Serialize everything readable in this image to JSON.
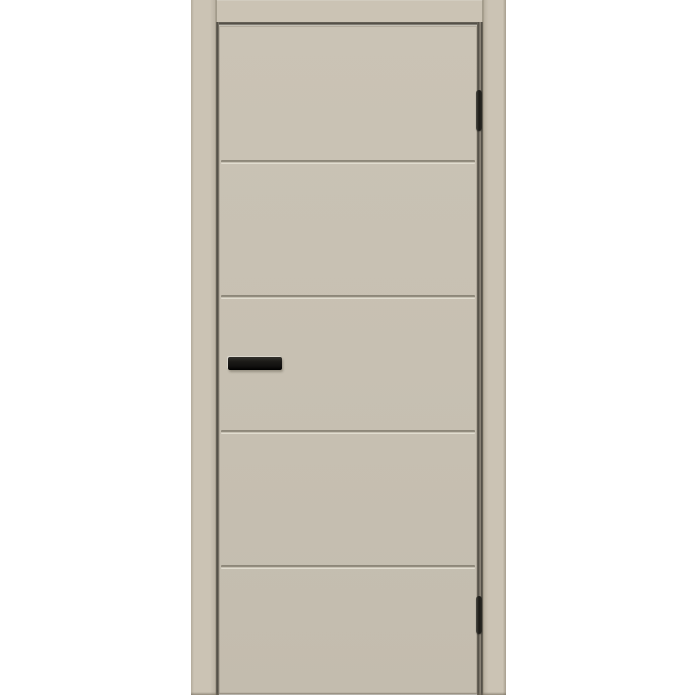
{
  "meta": {
    "type": "product-photo",
    "alt": "Light cashmere-beige painted interior door shown installed in a matching frame on a plain white background. The flush door leaf has four recessed horizontal grooves forming five flat panels, a rectangular matte black bar handle on the left side of the middle panel, and two slim black hinges on the right edge."
  },
  "door": {
    "finish": "cashmere beige, matte painted",
    "leaf": {
      "style": "flush leaf with horizontal grooves",
      "panel_count": 5
    },
    "grooves": {
      "count": 4,
      "positions_pct": [
        20.1,
        40.3,
        60.5,
        80.7
      ]
    },
    "handle": {
      "type": "rectangular bar handle",
      "side": "left",
      "finish": "matte black"
    },
    "hinges": {
      "count": 2,
      "side": "right",
      "finish": "black",
      "items": [
        {
          "top_pct": 12.9,
          "height_px": 41
        },
        {
          "top_pct": 85.7,
          "height_px": 38
        }
      ]
    },
    "frame": {
      "parts": [
        "left jamb",
        "top lintel",
        "right jamb"
      ]
    }
  },
  "colors": {
    "background": "#ffffff",
    "frame": "#cbc3b4",
    "leaf": "#c7c0b2",
    "edge": "#a89f8f",
    "gap_dark": "#4f4b43",
    "gap_mid": "#6e695e",
    "gap_light": "#a59d8e",
    "groove_dark": "#8d8779",
    "groove_light": "#e6e2d7",
    "hardware": "#1b1a17"
  }
}
